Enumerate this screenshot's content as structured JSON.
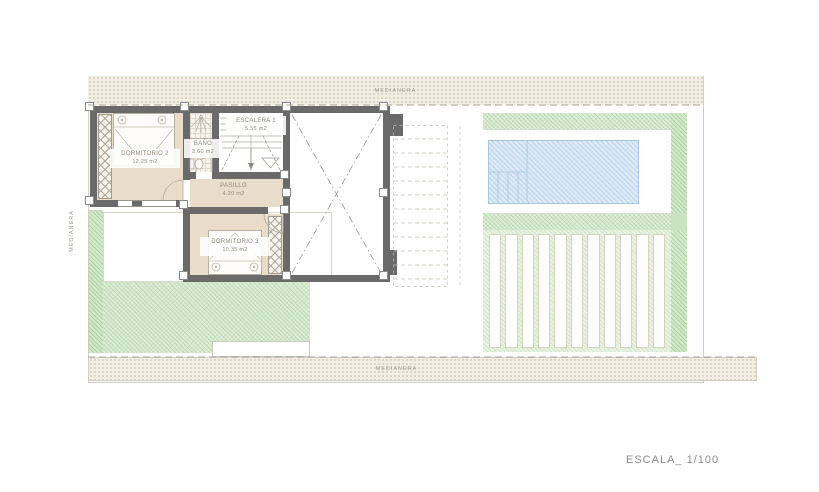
{
  "plan": {
    "rooms": [
      {
        "id": "dormitorio2",
        "name": "DORMITORIO 2",
        "area": "12.25 m2"
      },
      {
        "id": "bano",
        "name": "BAÑO",
        "area": "3.60 m2"
      },
      {
        "id": "escalera",
        "name": "ESCALERA 1",
        "area": "5.55 m2"
      },
      {
        "id": "pasillo",
        "name": "PASILLO",
        "area": "4.20 m2"
      },
      {
        "id": "dormitorio3",
        "name": "DORMITORIO 3",
        "area": "10.35 m2"
      }
    ],
    "boundaries": {
      "top": "MEDIANERA",
      "left": "MEDIANERA",
      "bottom": "MEDIANERA"
    },
    "scale_label": "ESCALA_ 1/100",
    "colors": {
      "wall": "#6a6a6a",
      "room_floor": "#e9dccb",
      "lawn": "#e0eed8",
      "pool": "#dce9f6",
      "boundary_band": "#f3eee4",
      "pergola": "#eaf2e3"
    }
  }
}
